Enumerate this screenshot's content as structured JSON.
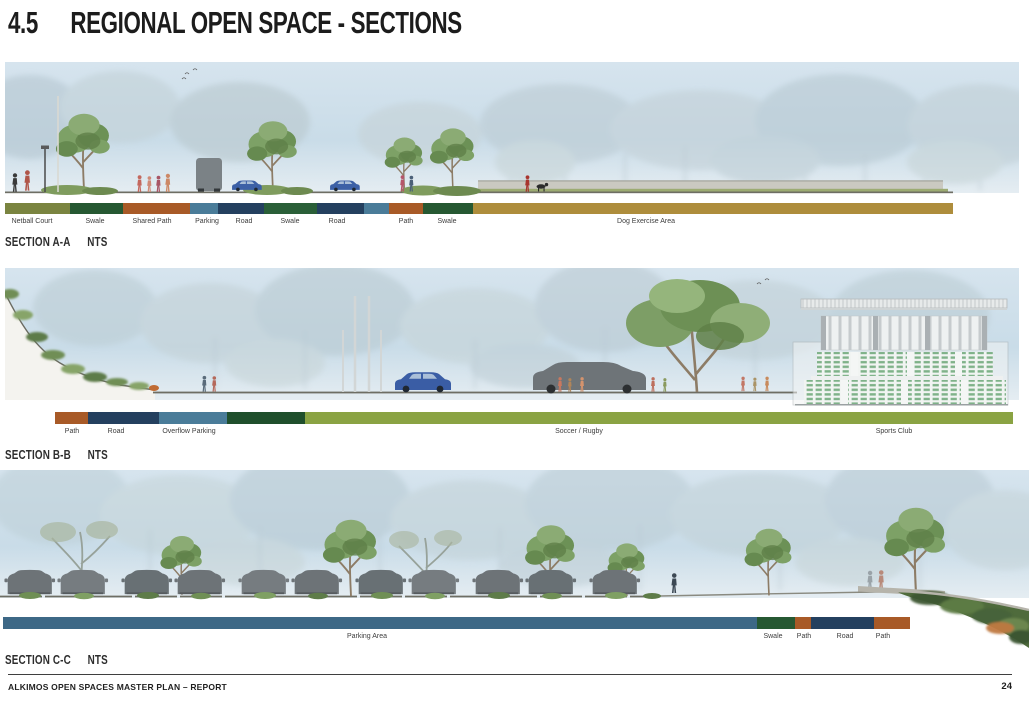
{
  "page": {
    "section_number": "4.5",
    "title": "REGIONAL OPEN SPACE - SECTIONS",
    "footer": "ALKIMOS OPEN SPACES MASTER PLAN – REPORT",
    "page_number": "24"
  },
  "legend_colors": {
    "netball_court": "#7a8440",
    "swale": "#265832",
    "path": "#a85a27",
    "parking": "#4a7c99",
    "road": "#24405f",
    "dog_exercise_area": "#ae8d3c",
    "soccer_rugby_field": "#8aa343",
    "parking_area": "#3d6886"
  },
  "sections": [
    {
      "name": "SECTION A-A",
      "scale": "NTS",
      "bar": {
        "y": 203,
        "h": 11,
        "segments": [
          {
            "color": "#7a8440",
            "x": 5,
            "w": 65,
            "labels": [
              {
                "text": "Netball Court",
                "cx": 32
              }
            ]
          },
          {
            "color": "#265832",
            "x": 70,
            "w": 53,
            "labels": [
              {
                "text": "Swale",
                "cx": 95
              }
            ]
          },
          {
            "color": "#a85a27",
            "x": 123,
            "w": 67,
            "labels": [
              {
                "text": "Shared Path",
                "cx": 152
              }
            ]
          },
          {
            "color": "#4a7c99",
            "x": 190,
            "w": 28,
            "labels": [
              {
                "text": "Parking",
                "cx": 207
              }
            ]
          },
          {
            "color": "#24405f",
            "x": 218,
            "w": 46,
            "labels": [
              {
                "text": "Road",
                "cx": 244
              }
            ]
          },
          {
            "color": "#2a5f38",
            "x": 264,
            "w": 53,
            "labels": [
              {
                "text": "Swale",
                "cx": 290
              }
            ]
          },
          {
            "color": "#24405f",
            "x": 317,
            "w": 47,
            "labels": [
              {
                "text": "Road",
                "cx": 337
              }
            ]
          },
          {
            "color": "#4a7c99",
            "x": 364,
            "w": 25,
            "labels": []
          },
          {
            "color": "#a85a27",
            "x": 389,
            "w": 34,
            "labels": [
              {
                "text": "Path",
                "cx": 406
              }
            ]
          },
          {
            "color": "#265832",
            "x": 423,
            "w": 50,
            "labels": [
              {
                "text": "Swale",
                "cx": 447
              }
            ]
          },
          {
            "color": "#ae8d3c",
            "x": 473,
            "w": 480,
            "labels": [
              {
                "text": "Dog Exercise Area",
                "cx": 646
              }
            ]
          }
        ]
      }
    },
    {
      "name": "SECTION B-B",
      "scale": "NTS",
      "bar": {
        "y": 412,
        "h": 12,
        "segments": [
          {
            "color": "#a85a27",
            "x": 55,
            "w": 33,
            "labels": [
              {
                "text": "Path",
                "cx": 72
              }
            ]
          },
          {
            "color": "#24405f",
            "x": 88,
            "w": 71,
            "labels": [
              {
                "text": "Road",
                "cx": 116
              }
            ]
          },
          {
            "color": "#4a7c99",
            "x": 159,
            "w": 68,
            "labels": [
              {
                "text": "Overflow Parking",
                "cx": 189
              }
            ]
          },
          {
            "color": "#1f4f2c",
            "x": 227,
            "w": 78,
            "labels": []
          },
          {
            "color": "#8aa343",
            "x": 305,
            "w": 708,
            "labels": [
              {
                "text": "Soccer / Rugby",
                "cx": 579
              },
              {
                "text": "Sports Club",
                "cx": 894
              }
            ]
          }
        ]
      }
    },
    {
      "name": "SECTION C-C",
      "scale": "NTS",
      "bar": {
        "y": 617,
        "h": 12,
        "segments": [
          {
            "color": "#3d6886",
            "x": 3,
            "w": 754,
            "labels": [
              {
                "text": "Parking Area",
                "cx": 367
              }
            ]
          },
          {
            "color": "#265832",
            "x": 757,
            "w": 38,
            "labels": [
              {
                "text": "Swale",
                "cx": 773
              }
            ]
          },
          {
            "color": "#a85a27",
            "x": 795,
            "w": 16,
            "labels": [
              {
                "text": "Path",
                "cx": 804
              }
            ]
          },
          {
            "color": "#24405f",
            "x": 811,
            "w": 63,
            "labels": [
              {
                "text": "Road",
                "cx": 845
              }
            ]
          },
          {
            "color": "#a85a27",
            "x": 874,
            "w": 36,
            "labels": [
              {
                "text": "Path",
                "cx": 883
              }
            ]
          }
        ]
      }
    }
  ]
}
